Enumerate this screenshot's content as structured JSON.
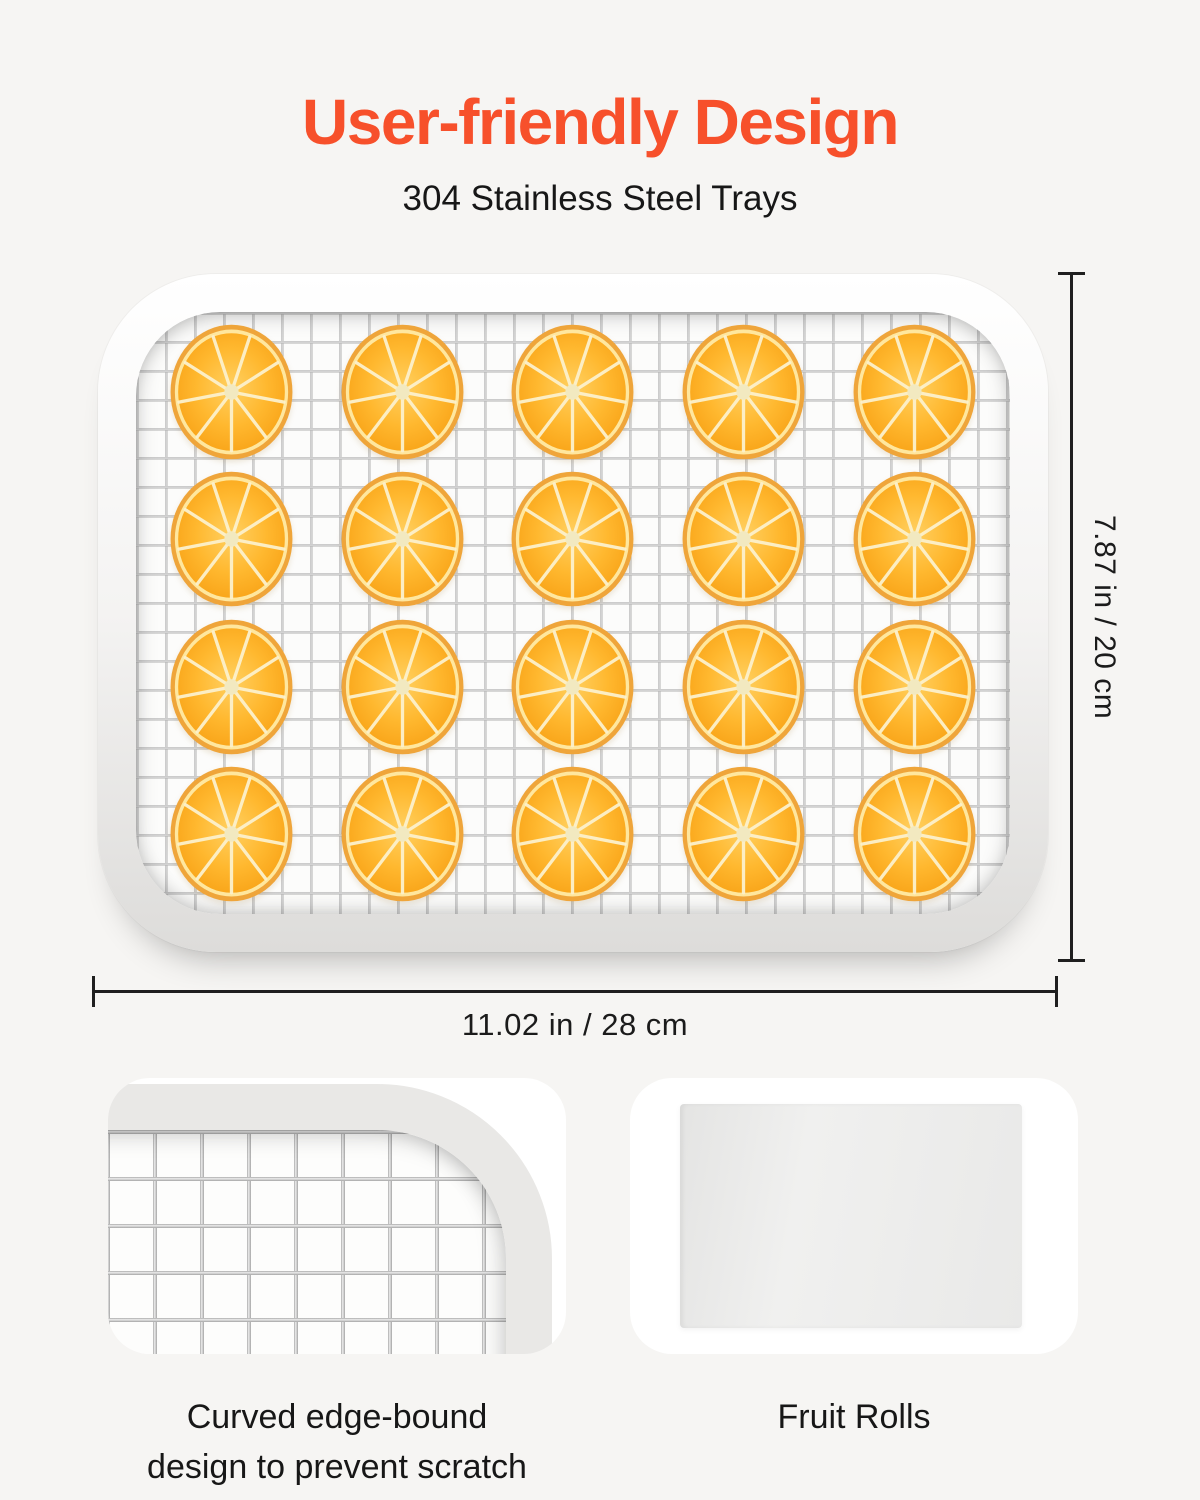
{
  "colors": {
    "accent_orange": "#F7502B",
    "text_dark": "#1B1B1B",
    "page_background": "#F6F5F3",
    "card_background": "#FFFFFF",
    "tray_frame": "#EDECEA",
    "mesh_wire": "#ABABAB",
    "slice_rind": "#EFA53A",
    "slice_flesh": "#FFB62E",
    "dimension_line": "#1F1F1F"
  },
  "header": {
    "title": "User-friendly Design",
    "subtitle": "304 Stainless Steel Trays"
  },
  "tray": {
    "description": "304 stainless steel mesh tray with orange slices",
    "rows": 4,
    "cols": 5,
    "slices": 20
  },
  "dimensions": {
    "height_label": "7.87 in / 20 cm",
    "width_label": "11.02 in / 28 cm"
  },
  "details": [
    {
      "id": "curved-edge",
      "caption_lines": [
        "Curved edge-bound",
        "design to prevent scratch"
      ]
    },
    {
      "id": "fruit-rolls",
      "caption_lines": [
        "Fruit Rolls"
      ]
    }
  ]
}
